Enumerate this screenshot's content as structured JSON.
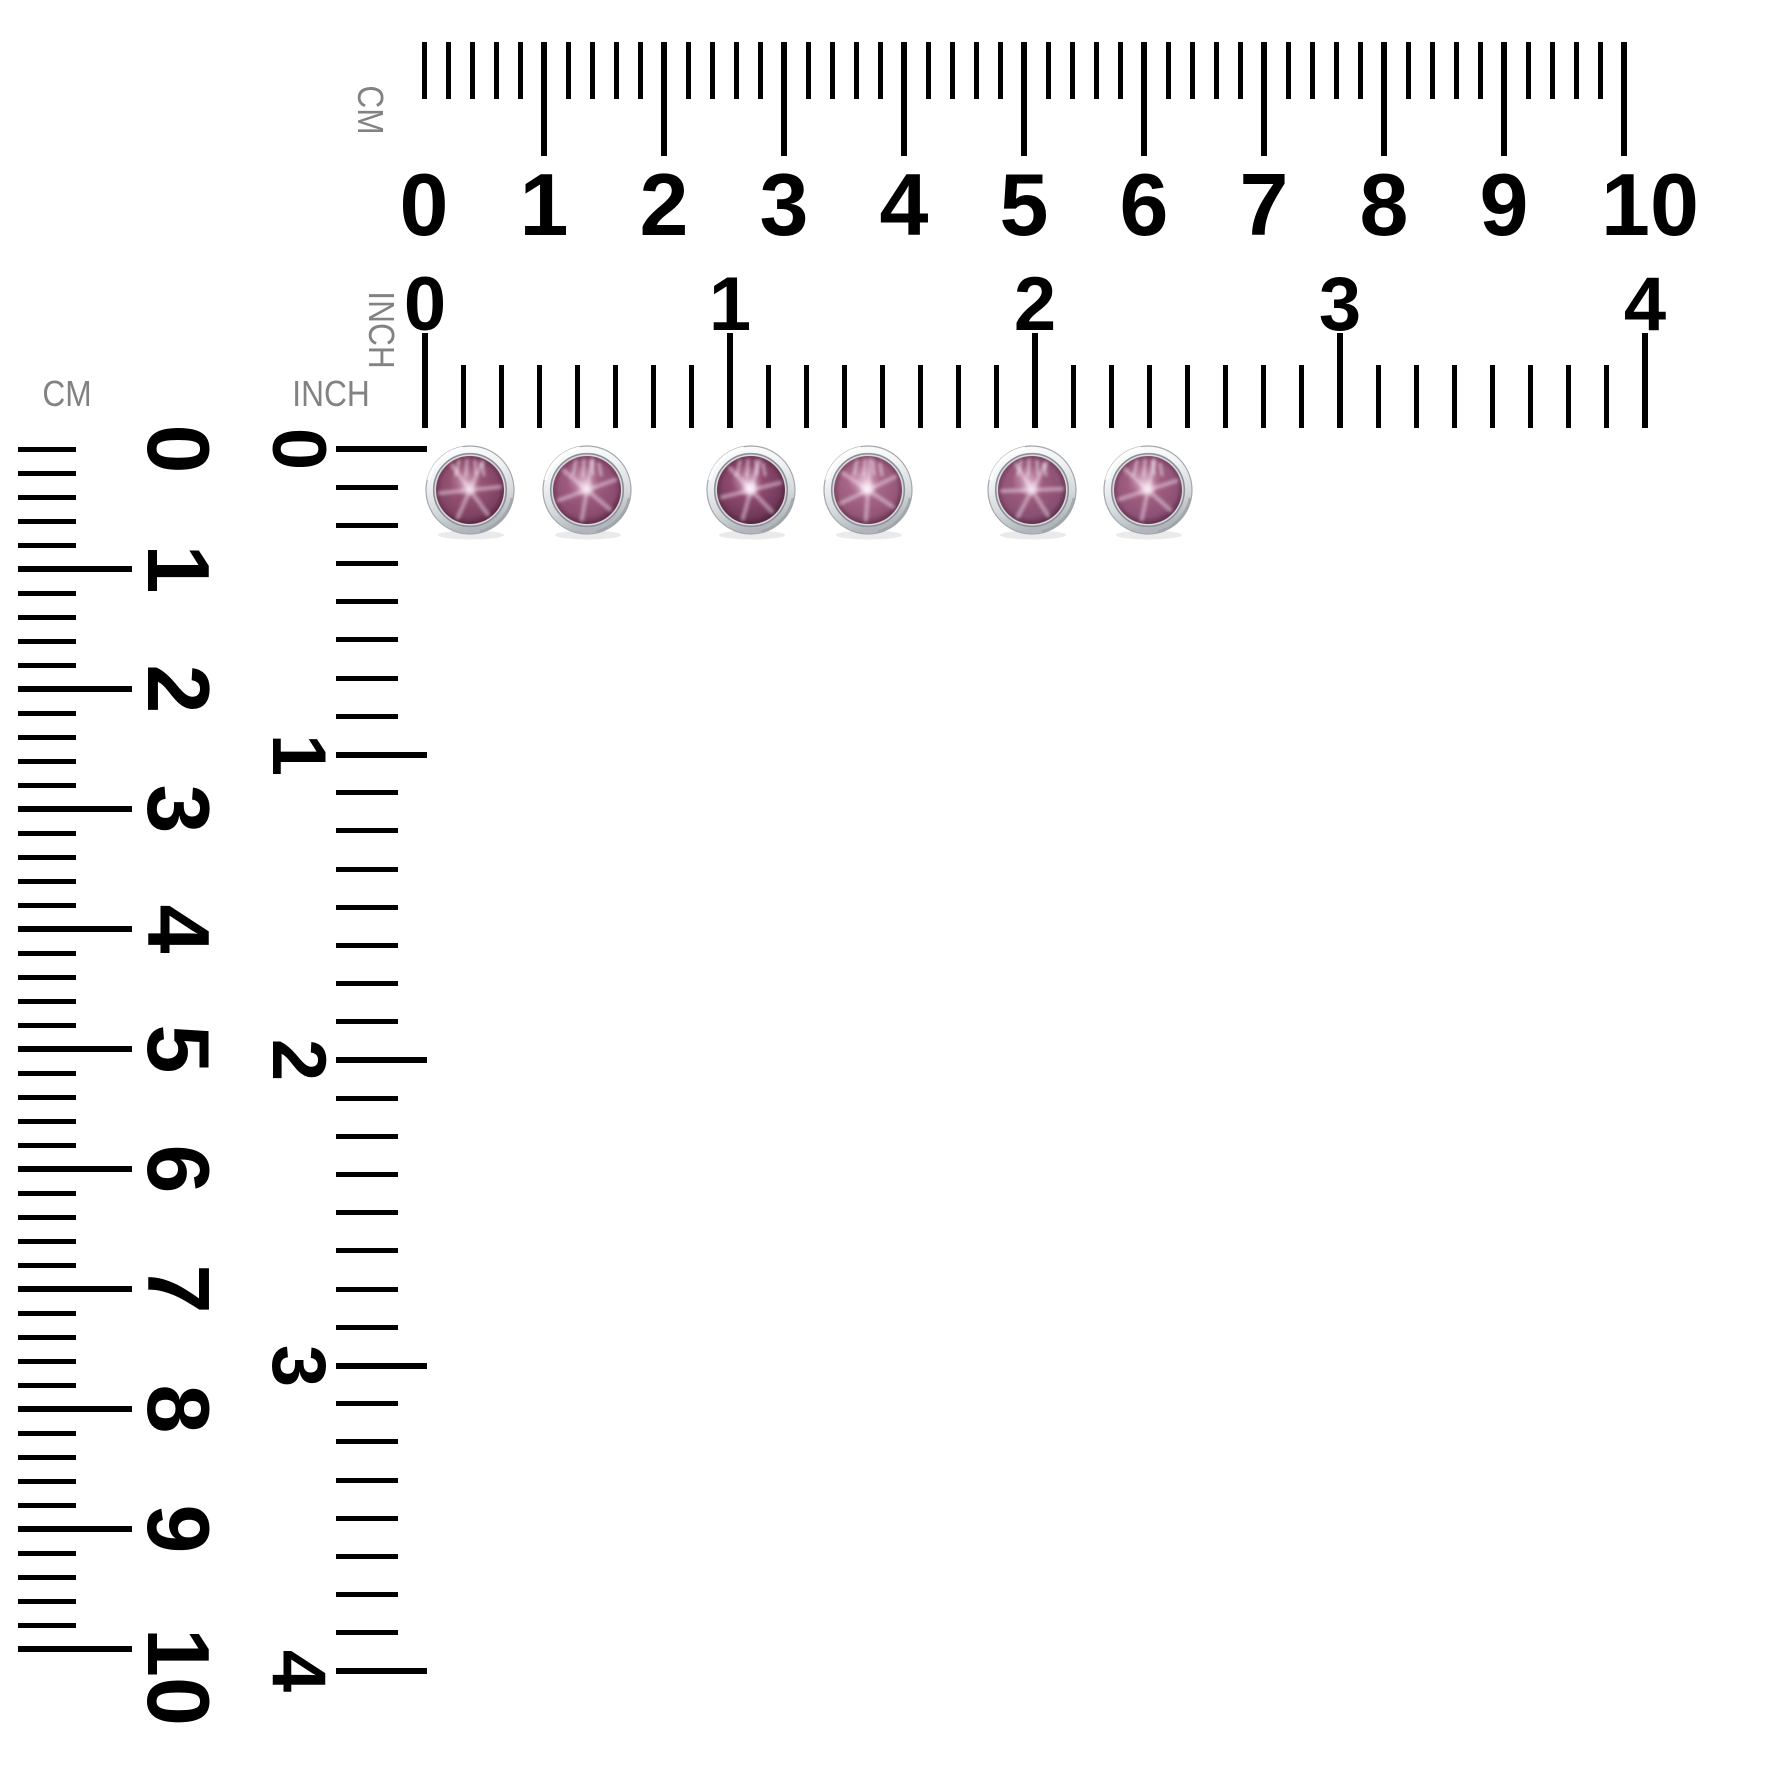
{
  "page": {
    "width": 1772,
    "height": 1772,
    "background": "#ffffff"
  },
  "labels": {
    "top_cm_rotated": "CM",
    "top_inch_rotated": "INCH",
    "left_cm_heading": "CM",
    "left_inch_heading": "INCH"
  },
  "label_style": {
    "color": "#828282"
  },
  "label_positions": {
    "top_cm_rotated": {
      "x": 370,
      "y": 110,
      "rotated": true
    },
    "top_inch_rotated": {
      "x": 381,
      "y": 330,
      "rotated": true
    },
    "left_cm_heading": {
      "x": 67,
      "y": 394,
      "rotated": false
    },
    "left_inch_heading": {
      "x": 331,
      "y": 394,
      "rotated": false
    }
  },
  "tick_style": {
    "color": "#000000",
    "minor_width": 5,
    "major_width": 6
  },
  "rulers": {
    "top_cm": {
      "unit": "cm",
      "numbers": [
        "0",
        "1",
        "2",
        "3",
        "4",
        "5",
        "6",
        "7",
        "8",
        "9",
        "10"
      ],
      "geometry": {
        "orientation": "h",
        "origin": 424,
        "edge": 42,
        "align_end": false,
        "minor_step": 24,
        "minors_per_label": 5,
        "tick_count": 51,
        "minor_len": 57,
        "major_len": 114,
        "zero_major": false,
        "numbers_cross": 205,
        "font_size": 88,
        "last_label_shift": 26
      }
    },
    "top_inch": {
      "unit": "inch",
      "numbers": [
        "0",
        "1",
        "2",
        "3",
        "4"
      ],
      "geometry": {
        "orientation": "h",
        "origin": 425,
        "edge": 428,
        "align_end": true,
        "minor_step": 38.125,
        "minors_per_label": 8,
        "tick_count": 33,
        "minor_len": 63,
        "major_len": 95,
        "zero_major": true,
        "numbers_cross": 305,
        "font_size": 76,
        "last_label_shift": 0
      }
    },
    "left_cm": {
      "unit": "cm",
      "numbers": [
        "0",
        "1",
        "2",
        "3",
        "4",
        "5",
        "6",
        "7",
        "8",
        "9",
        "10"
      ],
      "geometry": {
        "orientation": "v",
        "origin": 449,
        "edge": 18,
        "align_end": false,
        "minor_step": 24,
        "minors_per_label": 5,
        "tick_count": 51,
        "minor_len": 58,
        "major_len": 114,
        "zero_major": false,
        "numbers_cross": 178,
        "font_size": 88,
        "last_label_shift": 28
      }
    },
    "left_inch": {
      "unit": "inch",
      "numbers": [
        "0",
        "1",
        "2",
        "3",
        "4"
      ],
      "geometry": {
        "orientation": "v",
        "origin": 449,
        "edge": 336,
        "align_end": false,
        "minor_step": 38.19,
        "minors_per_label": 8,
        "tick_count": 33,
        "minor_len": 62,
        "major_len": 91,
        "zero_major": true,
        "numbers_cross": 298,
        "font_size": 76,
        "last_label_shift": 0
      }
    }
  },
  "gems": {
    "count": 6,
    "cy": 490,
    "radius": 44,
    "stone_radius": 34,
    "bezel": {
      "bright": "#ffffff",
      "light": "#f0f2f4",
      "mid": "#d6dadd",
      "shade": "#b0b6bb",
      "outline": "#a2a8ad",
      "seat": "#8f959a"
    },
    "items": [
      {
        "cx": 470,
        "light": "#c893ad",
        "mid": "#955272",
        "base": "#7f4263",
        "dark": "#4e2238",
        "star_angle": 24,
        "hotspot": 0.55
      },
      {
        "cx": 587,
        "light": "#d0a0bc",
        "mid": "#9d5c7f",
        "base": "#8a4c6f",
        "dark": "#562841",
        "star_angle": 10,
        "hotspot": 0.7
      },
      {
        "cx": 751,
        "light": "#d4a4c0",
        "mid": "#8f4a6f",
        "base": "#733a5b",
        "dark": "#451d33",
        "star_angle": 16,
        "hotspot": 0.95
      },
      {
        "cx": 868,
        "light": "#dcaec9",
        "mid": "#a76687",
        "base": "#945677",
        "dark": "#5d2f48",
        "star_angle": 4,
        "hotspot": 0.85
      },
      {
        "cx": 1032,
        "light": "#d3a3bf",
        "mid": "#9b5a7c",
        "base": "#885073",
        "dark": "#542945",
        "star_angle": 28,
        "hotspot": 0.6
      },
      {
        "cx": 1148,
        "light": "#d6a8c2",
        "mid": "#a05e80",
        "base": "#8d5276",
        "dark": "#572b44",
        "star_angle": 12,
        "hotspot": 0.75
      }
    ]
  }
}
